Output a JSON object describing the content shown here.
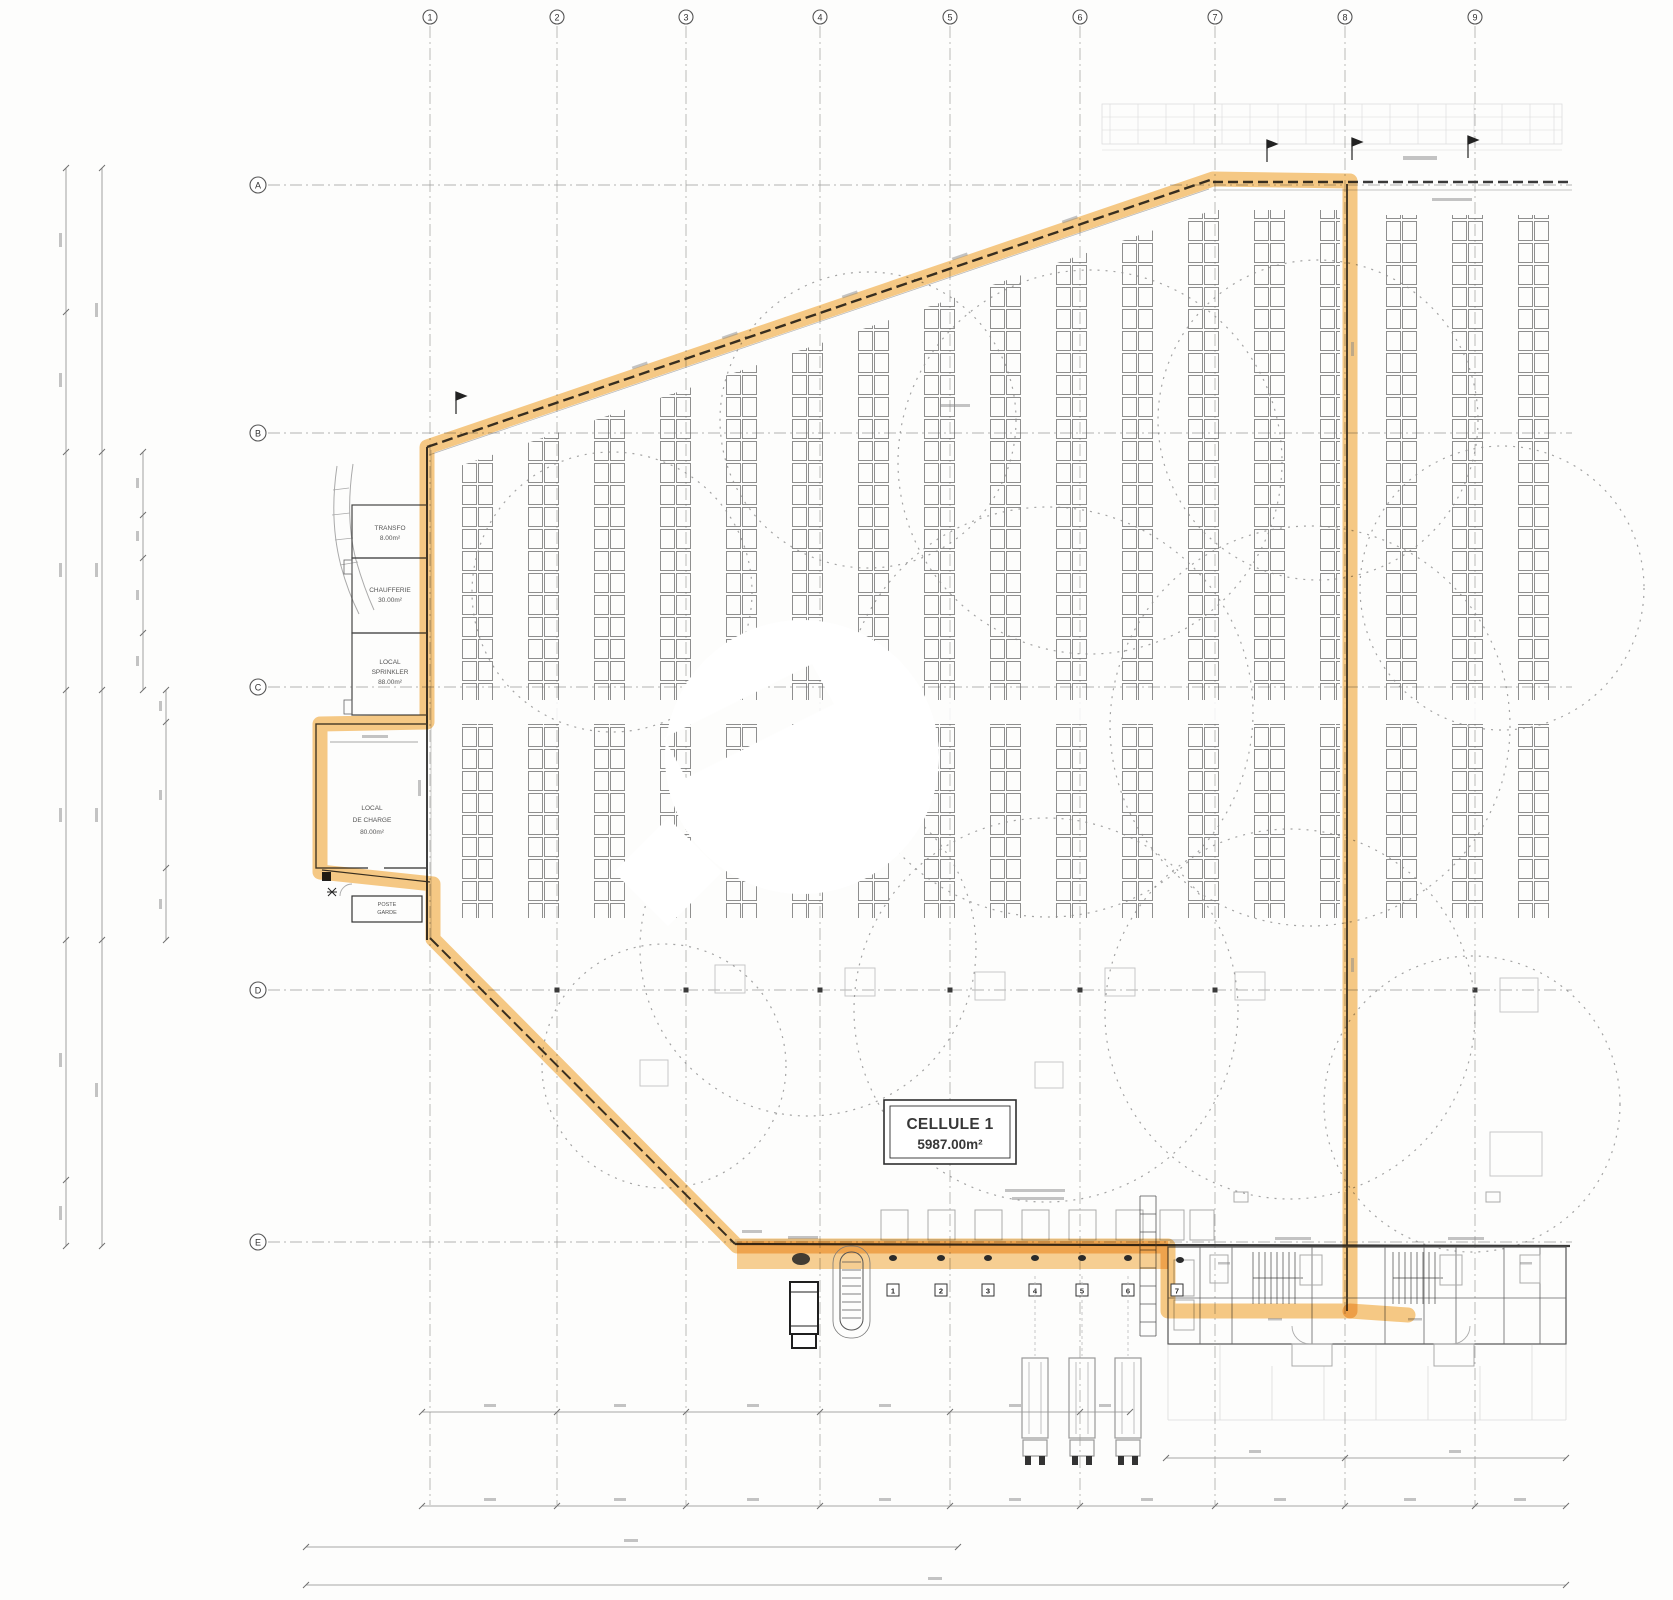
{
  "grid": {
    "columns": [
      "1",
      "2",
      "3",
      "4",
      "5",
      "6",
      "7",
      "8",
      "9"
    ],
    "rows": [
      "A",
      "B",
      "C",
      "D",
      "E"
    ]
  },
  "cell": {
    "title": "CELLULE 1",
    "area": "5987.00m²"
  },
  "rooms": {
    "transfo": [
      "TRANSFO",
      "8.00m²"
    ],
    "chaufferie": [
      "CHAUFFERIE",
      "30.00m²"
    ],
    "sprinkler": [
      "LOCAL",
      "SPRINKLER",
      "88.00m²"
    ],
    "charge": [
      "LOCAL",
      "DE CHARGE",
      "80.00m²"
    ],
    "garde": [
      "POSTE",
      "GARDE"
    ]
  },
  "dock": {
    "numbers": [
      "1",
      "2",
      "3",
      "4",
      "5",
      "6",
      "7"
    ]
  },
  "colors": {
    "highlight": "#F2A93B",
    "wall": "#3A3A3A",
    "line_gray": "#8A8A8A"
  }
}
